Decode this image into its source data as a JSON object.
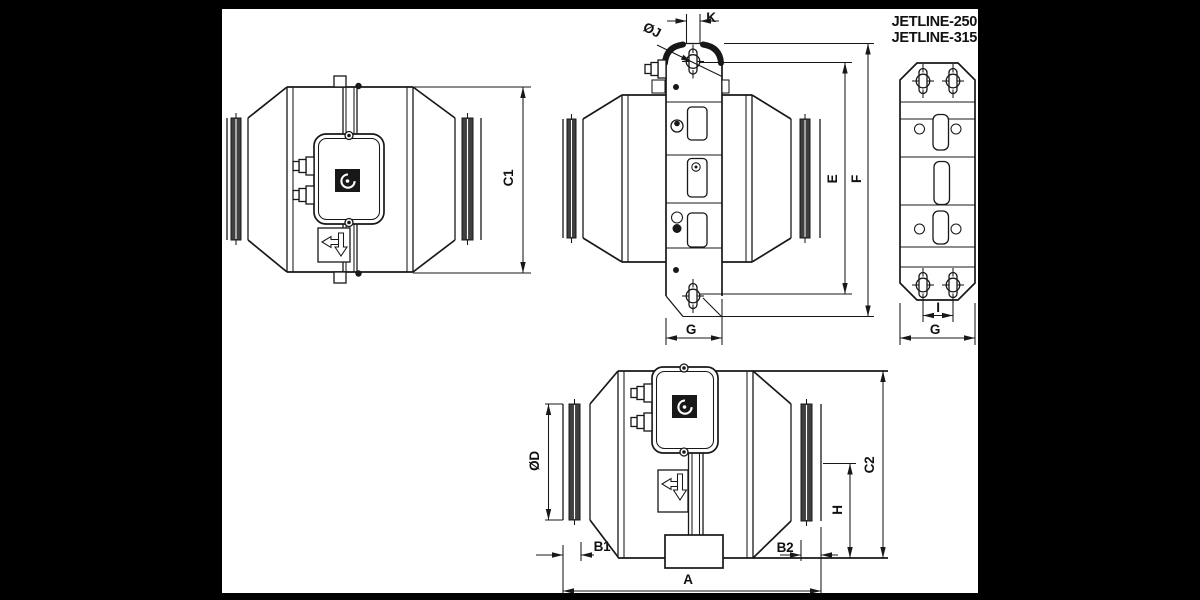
{
  "colors": {
    "frame_background": "#000000",
    "canvas": "#ffffff",
    "line": "#181818",
    "seal_band": "#404040"
  },
  "header": {
    "model_line_1": "JETLINE-250",
    "model_line_2": "JETLINE-315"
  },
  "dimension_labels": {
    "c1": "C1",
    "k": "K",
    "j_diameter": "ØJ",
    "e": "E",
    "f": "F",
    "g_bracket_side": "G",
    "i": "I",
    "g_bracket_front": "G",
    "d_diameter": "ØD",
    "b1": "B1",
    "b2": "B2",
    "a": "A",
    "h": "H",
    "c2": "C2"
  },
  "views": {
    "side_view": "fan side view",
    "bracket_side_view": "fan view with mounting bracket",
    "bracket_front_view": "mounting bracket front view",
    "bottom_view": "fan bottom view"
  }
}
